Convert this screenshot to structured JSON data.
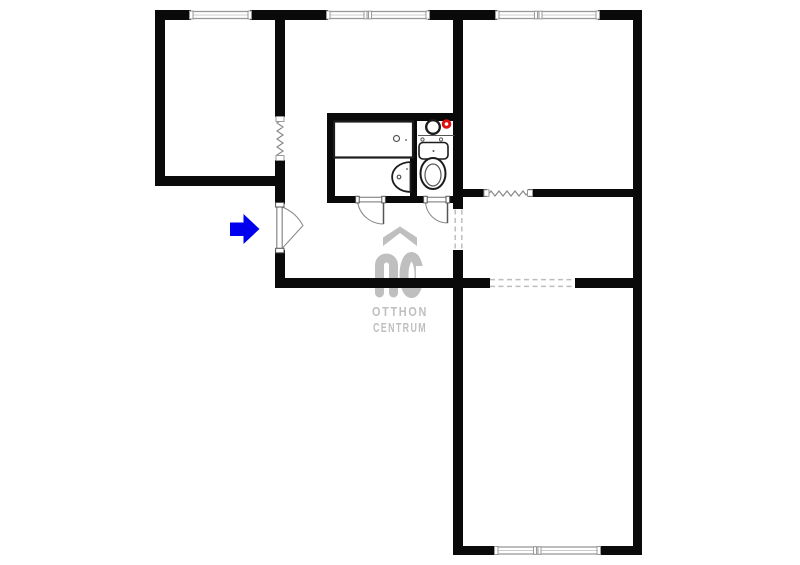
{
  "watermark": {
    "monogram": "OC",
    "line1": "OTTHON",
    "line2": "CENTRUM"
  },
  "icons": {
    "entrance_arrow": "blue-right-arrow",
    "roof": "house-roof-chevron",
    "water_heater": "black-ring",
    "gas_valve": "red-dot"
  },
  "colors": {
    "bg": "#ffffff",
    "wall": "#0a0a0a",
    "window-frame": "#999999",
    "window-mid": "#cccccc",
    "door": "#888888",
    "door-leaf": "#555555",
    "dashed": "#bdbdbd",
    "radiator": "#8a8a8a",
    "fixture": "#1c1c1c",
    "fixture-light": "#555555",
    "arrow-blue": "#0000ee",
    "valve-red": "#e01010",
    "watermark": "#bfbfbf"
  }
}
